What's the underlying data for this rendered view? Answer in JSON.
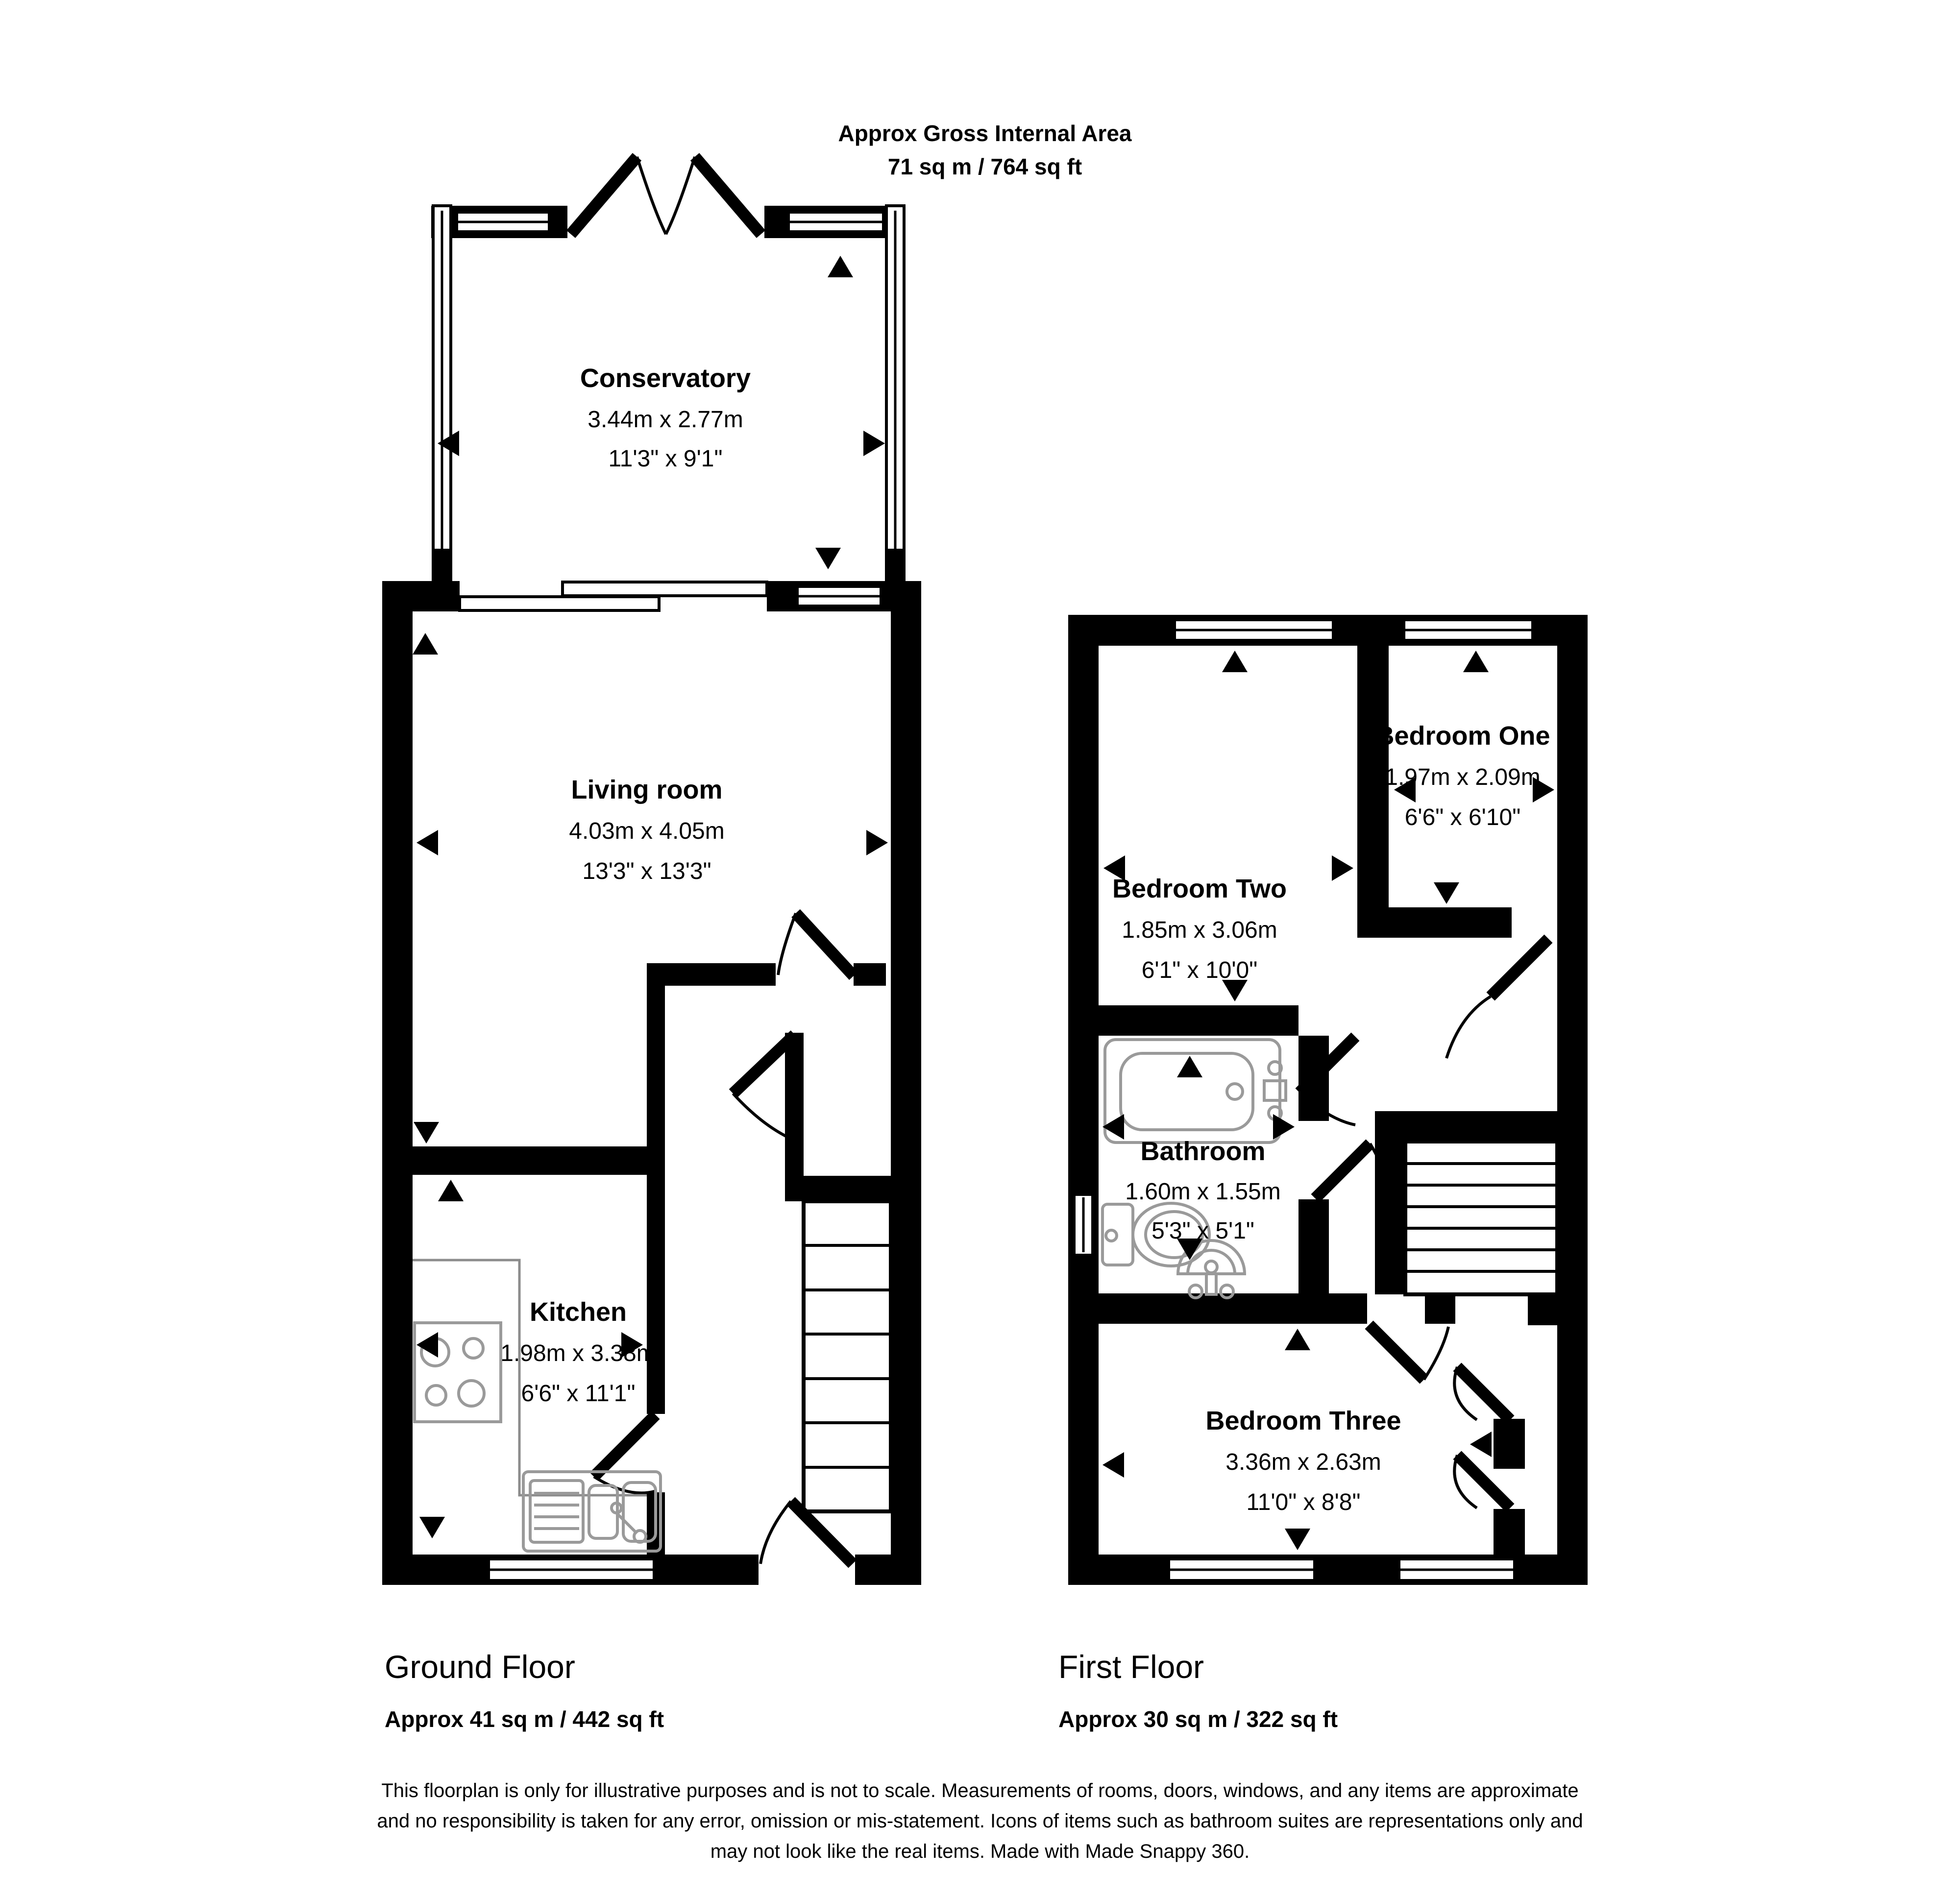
{
  "title": {
    "line1": "Approx Gross Internal Area",
    "line2": "71 sq m / 764 sq ft"
  },
  "rooms": {
    "conservatory": {
      "name": "Conservatory",
      "metric": "3.44m x 2.77m",
      "imperial": "11'3\" x 9'1\""
    },
    "living_room": {
      "name": "Living room",
      "metric": "4.03m x 4.05m",
      "imperial": "13'3\" x 13'3\""
    },
    "kitchen": {
      "name": "Kitchen",
      "metric": "1.98m x 3.38m",
      "imperial": "6'6\" x 11'1\""
    },
    "bedroom_one": {
      "name": "Bedroom One",
      "metric": "1.97m x 2.09m",
      "imperial": "6'6\" x 6'10\""
    },
    "bedroom_two": {
      "name": "Bedroom Two",
      "metric": "1.85m x 3.06m",
      "imperial": "6'1\" x 10'0\""
    },
    "bathroom": {
      "name": "Bathroom",
      "metric": "1.60m x 1.55m",
      "imperial": "5'3\" x 5'1\""
    },
    "bedroom_three": {
      "name": "Bedroom Three",
      "metric": "3.36m x 2.63m",
      "imperial": "11'0\" x 8'8\""
    }
  },
  "floors": {
    "ground": {
      "label": "Ground Floor",
      "area": "Approx 41 sq m / 442 sq ft"
    },
    "first": {
      "label": "First Floor",
      "area": "Approx 30 sq m / 322 sq ft"
    }
  },
  "disclaimer": {
    "line1": "This floorplan is only for illustrative purposes and is not to scale. Measurements of rooms, doors, windows, and any items are approximate",
    "line2": "and no responsibility is taken for any error, omission or mis-statement. Icons of items such as bathroom suites are representations only and",
    "line3": "may not look like the real items. Made with Made Snappy 360."
  },
  "colors": {
    "wall": "#000000",
    "background": "#ffffff",
    "fixture": "#9a9a9a"
  }
}
